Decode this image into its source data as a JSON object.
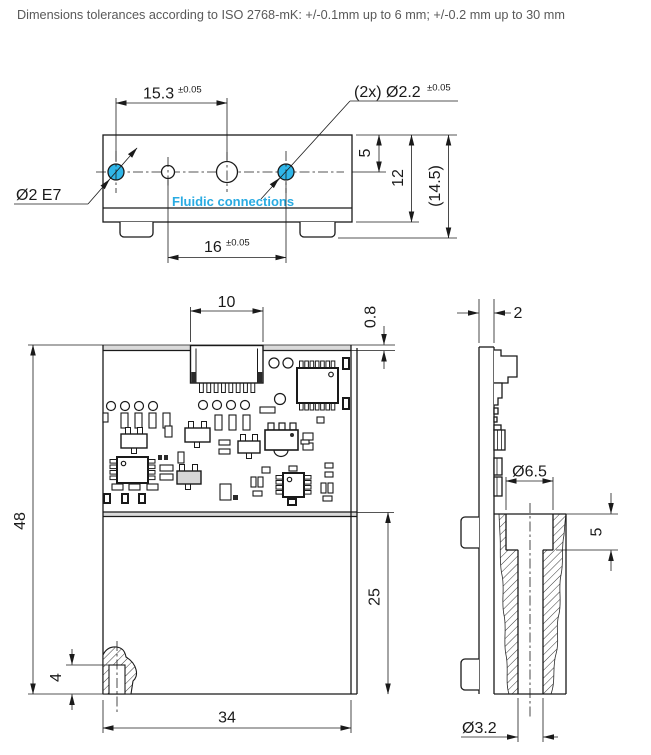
{
  "header": {
    "note": "Dimensions tolerances according to ISO 2768-mK: +/-0.1mm up to 6 mm; +/-0.2 mm up to 30 mm"
  },
  "top_view": {
    "dim_hole_spacing_top": {
      "value": "15.3",
      "tol": "±0.05"
    },
    "holes_callout": {
      "value": "(2x) Ø2.2",
      "tol": "±0.05"
    },
    "bore_callout": "Ø2 E7",
    "fluidic_label": "Fluidic connections",
    "dim_hole_spacing_bottom": {
      "value": "16",
      "tol": "±0.05"
    },
    "dim_hole_offset": "5",
    "dim_body_height": "12",
    "dim_total_height": "(14.5)"
  },
  "front_view": {
    "dim_connector_width": "10",
    "dim_pcb_protrusion": "0.8",
    "dim_total_height": "48",
    "dim_lower_height": "25",
    "dim_width": "34",
    "dim_port_height": "4",
    "pcb_components": [
      {
        "t": "connector",
        "x": 190.5,
        "y": 345.5,
        "w": 72.5,
        "h": 37.5,
        "pins": 8
      },
      {
        "t": "via",
        "x": 111,
        "y": 406,
        "r": 4.5
      },
      {
        "t": "via",
        "x": 125,
        "y": 406,
        "r": 4.5
      },
      {
        "t": "via",
        "x": 139,
        "y": 406,
        "r": 4.5
      },
      {
        "t": "via",
        "x": 153,
        "y": 406,
        "r": 4.5
      },
      {
        "t": "via",
        "x": 203,
        "y": 405,
        "r": 4.5
      },
      {
        "t": "via",
        "x": 217,
        "y": 405,
        "r": 4.5
      },
      {
        "t": "via",
        "x": 231,
        "y": 405,
        "r": 4.5
      },
      {
        "t": "via",
        "x": 245,
        "y": 405,
        "r": 4.5
      },
      {
        "t": "via",
        "x": 274,
        "y": 363,
        "r": 5
      },
      {
        "t": "via",
        "x": 288,
        "y": 363,
        "r": 5
      },
      {
        "t": "via",
        "x": 280,
        "y": 399,
        "r": 5.5
      },
      {
        "t": "pad",
        "x": 103,
        "y": 413,
        "w": 5,
        "h": 9
      },
      {
        "t": "pad",
        "x": 121,
        "y": 413,
        "w": 7,
        "h": 15
      },
      {
        "t": "pad",
        "x": 135,
        "y": 413,
        "w": 7,
        "h": 15
      },
      {
        "t": "pad",
        "x": 149,
        "y": 413,
        "w": 7,
        "h": 15
      },
      {
        "t": "pad",
        "x": 163,
        "y": 413,
        "w": 7,
        "h": 15
      },
      {
        "t": "pad",
        "x": 215,
        "y": 415,
        "w": 7,
        "h": 15
      },
      {
        "t": "pad",
        "x": 229,
        "y": 415,
        "w": 7,
        "h": 15
      },
      {
        "t": "pad",
        "x": 243,
        "y": 415,
        "w": 7,
        "h": 15
      },
      {
        "t": "pad",
        "x": 260,
        "y": 407,
        "w": 15,
        "h": 6
      },
      {
        "t": "pad",
        "x": 165,
        "y": 426,
        "w": 7,
        "h": 11
      },
      {
        "t": "pad",
        "x": 303,
        "y": 433,
        "w": 10,
        "h": 7
      },
      {
        "t": "pad",
        "x": 303,
        "y": 443,
        "w": 10,
        "h": 7
      },
      {
        "t": "pad",
        "x": 317,
        "y": 417,
        "w": 7,
        "h": 6
      },
      {
        "t": "padd",
        "x": 343,
        "y": 358,
        "w": 6,
        "h": 11
      },
      {
        "t": "padd",
        "x": 343,
        "y": 398,
        "w": 6,
        "h": 11
      },
      {
        "t": "pad",
        "x": 160,
        "y": 465,
        "w": 13,
        "h": 6
      },
      {
        "t": "pad",
        "x": 160,
        "y": 474,
        "w": 13,
        "h": 6
      },
      {
        "t": "pad",
        "x": 178,
        "y": 452,
        "w": 6,
        "h": 11
      },
      {
        "t": "padf",
        "x": 158,
        "y": 455,
        "w": 4,
        "h": 5
      },
      {
        "t": "padf",
        "x": 164,
        "y": 455,
        "w": 4,
        "h": 5
      },
      {
        "t": "pad",
        "x": 112,
        "y": 484,
        "w": 11,
        "h": 6
      },
      {
        "t": "pad",
        "x": 129,
        "y": 484,
        "w": 11,
        "h": 6
      },
      {
        "t": "pad",
        "x": 147,
        "y": 484,
        "w": 11,
        "h": 6
      },
      {
        "t": "padd",
        "x": 104,
        "y": 494,
        "w": 6,
        "h": 9
      },
      {
        "t": "padd",
        "x": 122,
        "y": 494,
        "w": 6,
        "h": 9
      },
      {
        "t": "padd",
        "x": 139,
        "y": 494,
        "w": 6,
        "h": 9
      },
      {
        "t": "pad",
        "x": 219,
        "y": 440,
        "w": 11,
        "h": 5
      },
      {
        "t": "pad",
        "x": 219,
        "y": 449,
        "w": 11,
        "h": 5
      },
      {
        "t": "pad",
        "x": 262,
        "y": 467,
        "w": 8,
        "h": 6
      },
      {
        "t": "pad",
        "x": 251,
        "y": 477,
        "w": 5,
        "h": 10
      },
      {
        "t": "pad",
        "x": 258,
        "y": 477,
        "w": 5,
        "h": 10
      },
      {
        "t": "pad",
        "x": 253,
        "y": 491,
        "w": 9,
        "h": 5
      },
      {
        "t": "pad",
        "x": 220,
        "y": 484,
        "w": 11,
        "h": 16
      },
      {
        "t": "padf",
        "x": 233,
        "y": 495,
        "w": 5,
        "h": 5
      },
      {
        "t": "pad",
        "x": 289,
        "y": 466,
        "w": 8,
        "h": 5
      },
      {
        "t": "padd",
        "x": 288,
        "y": 499,
        "w": 8,
        "h": 6
      },
      {
        "t": "pad",
        "x": 325,
        "y": 463,
        "w": 8,
        "h": 5
      },
      {
        "t": "pad",
        "x": 325,
        "y": 472,
        "w": 8,
        "h": 5
      },
      {
        "t": "pad",
        "x": 321,
        "y": 483,
        "w": 5,
        "h": 10
      },
      {
        "t": "pad",
        "x": 328,
        "y": 483,
        "w": 5,
        "h": 10
      },
      {
        "t": "pad",
        "x": 323,
        "y": 496,
        "w": 9,
        "h": 5
      },
      {
        "t": "pad",
        "x": 301,
        "y": 440,
        "w": 8,
        "h": 4
      },
      {
        "t": "sot",
        "x": 121,
        "y": 434,
        "w": 26,
        "h": 14,
        "up": [
          128,
          140
        ],
        "down": [
          134
        ]
      },
      {
        "t": "sot",
        "x": 185,
        "y": 428,
        "w": 25,
        "h": 14,
        "up": [
          191,
          204
        ],
        "down": [
          197
        ]
      },
      {
        "t": "sot",
        "x": 238,
        "y": 441,
        "w": 22,
        "h": 12,
        "up": [
          243,
          255
        ],
        "down": [
          249
        ]
      },
      {
        "t": "sotg",
        "x": 177,
        "y": 471,
        "w": 24,
        "h": 13,
        "up": [
          182,
          195
        ],
        "down": [
          188
        ]
      },
      {
        "t": "power",
        "x": 265,
        "y": 430,
        "w": 33,
        "h": 20,
        "legs": [
          271,
          282,
          293
        ],
        "bump": 281,
        "dot": [
          292,
          435
        ]
      },
      {
        "t": "chip_tb",
        "x": 297,
        "y": 368,
        "w": 41,
        "h": 35,
        "pins": 7
      },
      {
        "t": "chip_lr",
        "x": 117,
        "y": 457,
        "w": 31,
        "h": 26,
        "pins": 4
      },
      {
        "t": "chip_lr",
        "x": 283,
        "y": 473,
        "w": 21,
        "h": 24,
        "pins": 4
      }
    ]
  },
  "side_view": {
    "dim_thickness": "2",
    "dim_counterbore": "Ø6.5",
    "dim_counterbore_depth": "5",
    "dim_bore": "Ø3.2"
  },
  "colors": {
    "line": "#1a1a1a",
    "accent_cyan": "#29abe2",
    "hole_fill": "#2fb5e8",
    "note_gray": "#595959",
    "band_gray": "#dadada"
  }
}
